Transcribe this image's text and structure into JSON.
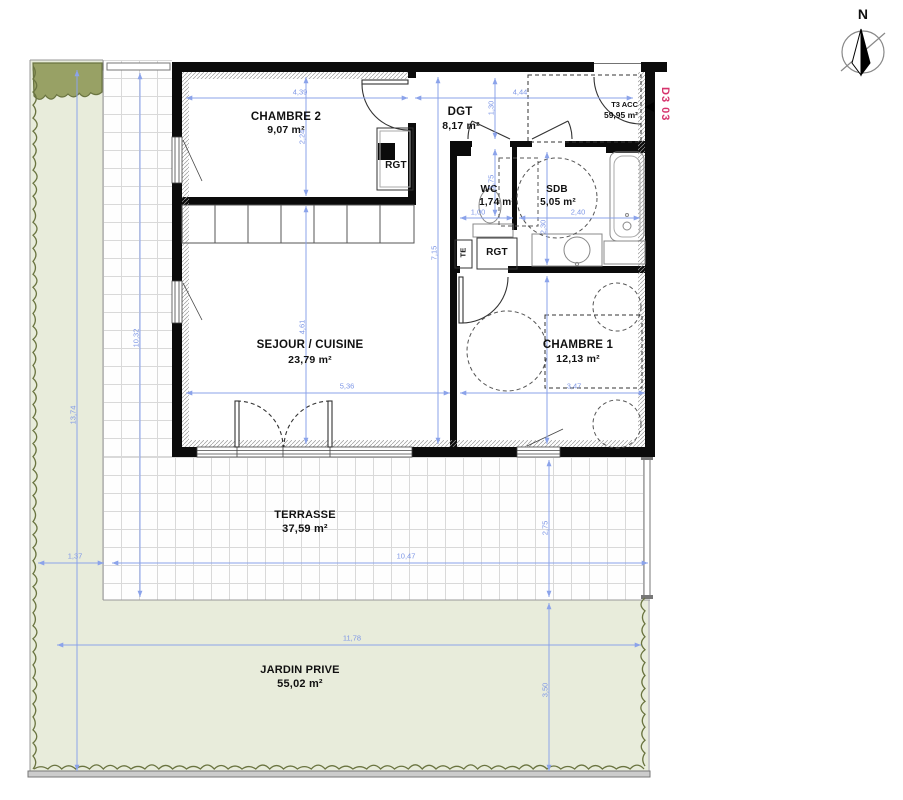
{
  "title": {
    "north": "N",
    "plan_code": "D3 03"
  },
  "unit": {
    "type_label": "T3 ACC",
    "total_area": "59,95 m²"
  },
  "rooms": {
    "chambre2": {
      "name": "CHAMBRE 2",
      "area": "9,07 m²"
    },
    "dgt": {
      "name": "DGT",
      "area": "8,17 m²"
    },
    "wc": {
      "name": "WC",
      "area": "1,74 m²"
    },
    "sdb": {
      "name": "SDB",
      "area": "5,05 m²"
    },
    "sejour": {
      "name": "SEJOUR / CUISINE",
      "area": "23,79 m²"
    },
    "chambre1": {
      "name": "CHAMBRE 1",
      "area": "12,13 m²"
    },
    "terrasse": {
      "name": "TERRASSE",
      "area": "37,59 m²"
    },
    "jardin": {
      "name": "JARDIN PRIVE",
      "area": "55,02 m²"
    }
  },
  "labels": {
    "rgt1": "RGT",
    "rgt2": "RGT",
    "te": "TE"
  },
  "dimensions": {
    "chambre2_width": "4,39",
    "chambre2_height": "2,24",
    "dgt_width": "4,44",
    "dgt_height": "1,30",
    "wc_width": "1,00",
    "wc_height": "1,75",
    "sdb_width": "2,40",
    "sdb_height": "2,30",
    "sejour_width": "5,36",
    "sejour_height": "4,61",
    "chambre1_width": "3,47",
    "building_height": "7,15",
    "terrasse_height": "10,32",
    "terrasse_width": "10,47",
    "terrasse_offset": "1,37",
    "terrasse_depth": "2,75",
    "jardin_width": "11,78",
    "jardin_depth": "3,50",
    "site_height": "13,74"
  },
  "colors": {
    "dimension_blue": "#8ba3ea",
    "plan_code_pink": "#d6336c",
    "garden_green": "#e8ecdb",
    "hedge_olive": "#6a7440",
    "wall_black": "#0b0b0b",
    "tile_line_gray": "#d9d9d9"
  }
}
